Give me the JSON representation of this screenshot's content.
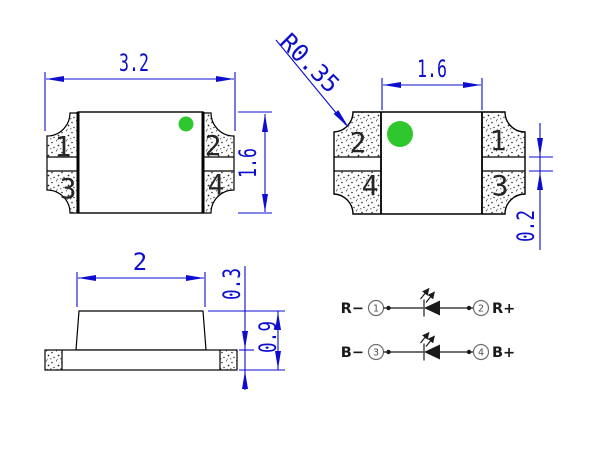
{
  "drawing": {
    "colors": {
      "dimension_blue": "#0d0dd0",
      "marker_green": "#2ec82e",
      "outline_black": "#000000",
      "schematic_dark": "#1a1a1a"
    },
    "top_view": {
      "width_dim": "3.2",
      "height_dim": "1.6",
      "pads": [
        "1",
        "2",
        "3",
        "4"
      ]
    },
    "bottom_view": {
      "pitch_dim": "1.6",
      "corner_radius_dim": "R0.35",
      "gap_dim": "0.2",
      "pads": [
        "2",
        "1",
        "4",
        "3"
      ]
    },
    "side_view": {
      "body_width_dim": "2",
      "base_thickness_dim": "0.3",
      "total_height_dim": "0.9"
    },
    "schematic": {
      "rows": [
        {
          "left_label": "R−",
          "left_pin": "1",
          "right_pin": "2",
          "right_label": "R+"
        },
        {
          "left_label": "B−",
          "left_pin": "3",
          "right_pin": "4",
          "right_label": "B+"
        }
      ]
    }
  }
}
